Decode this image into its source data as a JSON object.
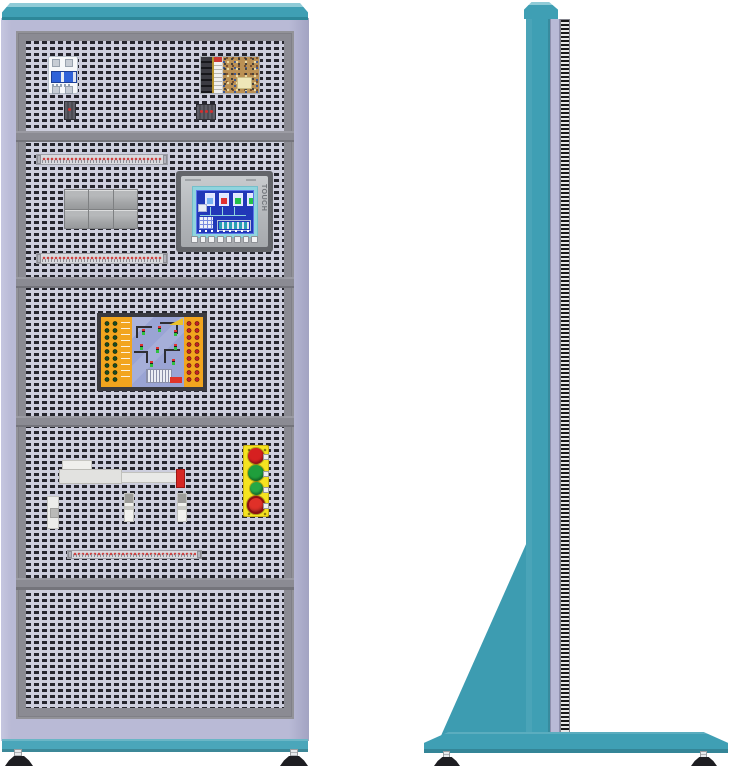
{
  "illustration": {
    "subject": "electrical-training-cabinet",
    "views": [
      {
        "name": "front-view"
      },
      {
        "name": "side-view"
      }
    ]
  },
  "colors": {
    "teal": "#3F9FB4",
    "teal_light": "#8FCBD7",
    "teal_dark": "#2D8799",
    "lavender": "#B9BAD6",
    "frame_gray": "#8B8B93",
    "perforation_bg": "#CDCEDD",
    "perforation_dash": "#26262E",
    "station_yellow": "#F5E320",
    "plc_orange": "#F2A51E",
    "plc_board_blue": "#9AA4D4",
    "hmi_screen_blue": "#2138B8",
    "hmi_bezel_teal": "#8FD4DE",
    "red": "#D62724",
    "green": "#1F9E3C"
  },
  "front": {
    "sections": 5,
    "hmi": {
      "label": "TOUCH",
      "function_key_count": 8,
      "screen_tanks": [
        "#7AB3F2",
        "#E03030",
        "#22C14A",
        "#22C14A"
      ]
    },
    "button_station": {
      "buttons": [
        {
          "color": "#D62020",
          "type": "push-button"
        },
        {
          "color": "#1F9E3C",
          "type": "push-button"
        },
        {
          "color": "#27A845",
          "type": "push-button",
          "size": "small"
        },
        {
          "color": "#E03028",
          "type": "emergency-stop-button"
        }
      ]
    },
    "relay_block": {
      "rows": 2,
      "cols": 3
    },
    "terminal_rail_count": 3,
    "components": [
      "circuit-breaker",
      "switching-power-supply",
      "terminal-rail",
      "relay-group",
      "hmi-touch-panel",
      "plc-trainer-module",
      "linear-actuator",
      "inductive-sensor",
      "pushbutton-station",
      "leveling-feet"
    ]
  },
  "side": {
    "features": [
      "top-cap",
      "column",
      "perforated-panel-edge",
      "support-gusset",
      "base-plate",
      "leveling-feet"
    ]
  }
}
